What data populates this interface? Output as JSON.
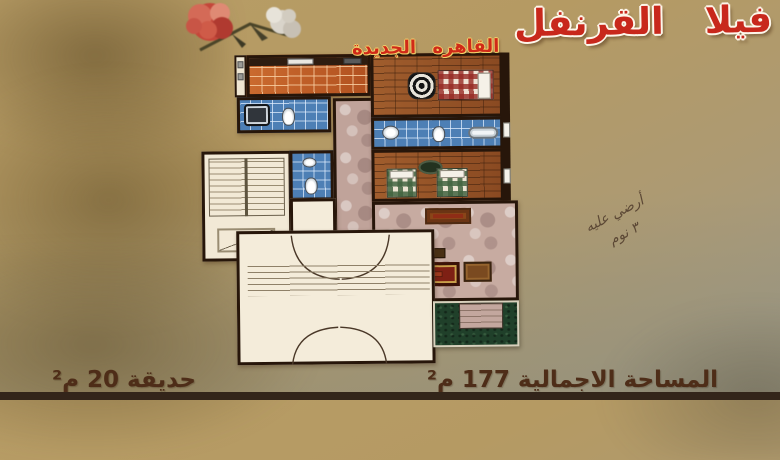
{
  "poster": {
    "title": "فيلا القرنفل",
    "subtitle": "القاهره الجديدة",
    "total_area_label": "المساحة الاجمالية 177 م²",
    "garden_label": "حديقة 20 م²",
    "handwritten_note": {
      "line1": "أرضي عليه",
      "line2": "٣ نوم"
    },
    "image": "carnation-flowers-photo"
  },
  "colors": {
    "background_tan": "#b59a63",
    "title_red": "#c8281c",
    "subtitle_red": "#d02a18",
    "subtitle_outline_yellow": "#f3d26b",
    "caption_brown": "#4e2d18",
    "wall_dark": "#27160a",
    "kitchen_tile_orange": "#bf5d26",
    "bathroom_tile_blue": "#4d7fb5",
    "wood_floor_brown": "#98562a",
    "marble_floor_pink": "#c0a39a",
    "garden_green": "#20402a",
    "rug_red": "#7e2014"
  }
}
